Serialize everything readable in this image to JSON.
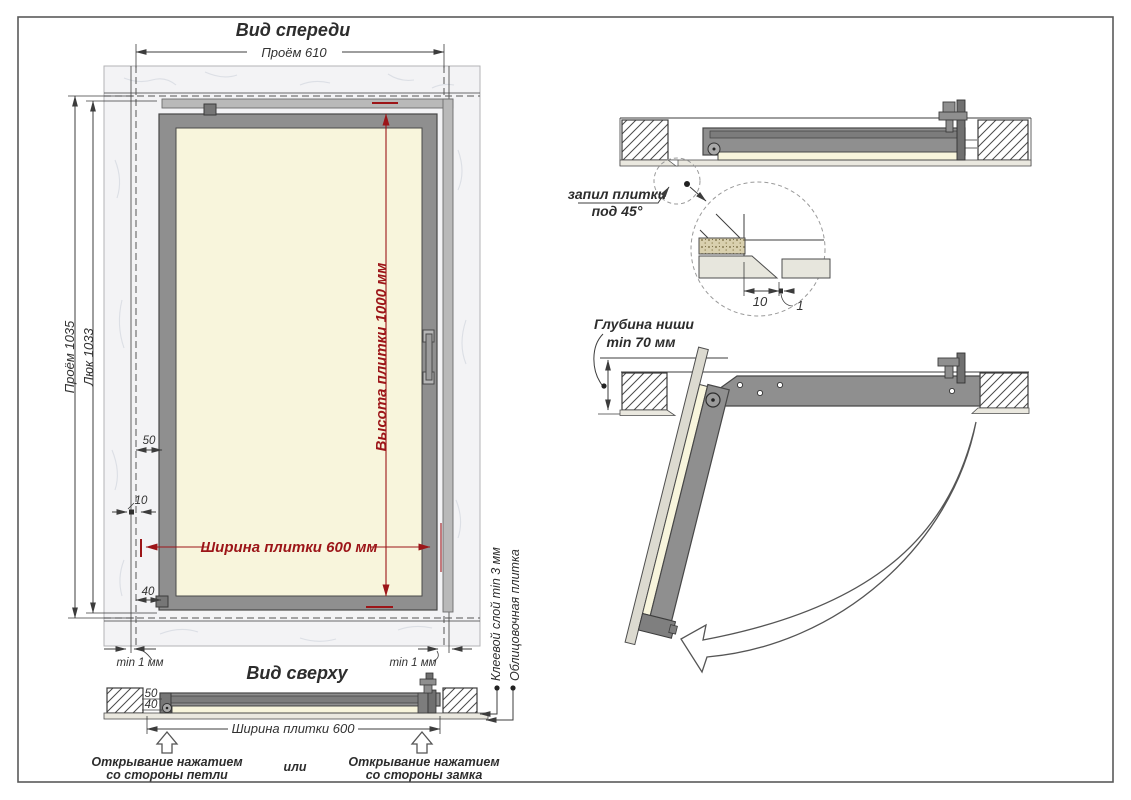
{
  "drawing": {
    "subject": "tile access hatch installation drawing"
  },
  "front_view": {
    "title": "Вид спереди",
    "dim_opening_width": "Проём 610",
    "dim_opening_height": "Проём 1035",
    "dim_hatch_height": "Люк 1033",
    "dim_tile_height": "Высота плитки 1000 мм",
    "dim_tile_width": "Ширина плитки 600 мм",
    "dim_frame_offset": "50",
    "dim_gap_offset": "10",
    "dim_bottom_offset": "40",
    "gap_min_left": "min 1 мм",
    "gap_min_right": "min 1 мм"
  },
  "top_view": {
    "title": "Вид сверху",
    "dim_depth_50": "50",
    "dim_depth_40": "40",
    "dim_tile_width": "Ширина плитки 600",
    "label_adhesive": "Клеевой слой min 3 мм",
    "label_tile": "Облицовочная плитка"
  },
  "opening_notes": {
    "hinge_line1": "Открывание нажатием",
    "hinge_line2": "со стороны петли",
    "or_word": "или",
    "lock_line1": "Открывание нажатием",
    "lock_line2": "со стороны замка"
  },
  "section_closed": {
    "tile_cut_line1": "запил плитки",
    "tile_cut_line2": "под 45°",
    "detail_dim_width": "10",
    "detail_dim_gap": "1"
  },
  "section_open": {
    "niche_depth_line1": "Глубина ниши",
    "niche_depth_line2": "min 70 мм"
  },
  "colors": {
    "accent_red": "#9c1518",
    "frame_gray": "#8f8f8f",
    "tile_cream": "#f8f5dc",
    "wall_marble": "#f3f3f5",
    "line_dark": "#3c3c3c"
  }
}
